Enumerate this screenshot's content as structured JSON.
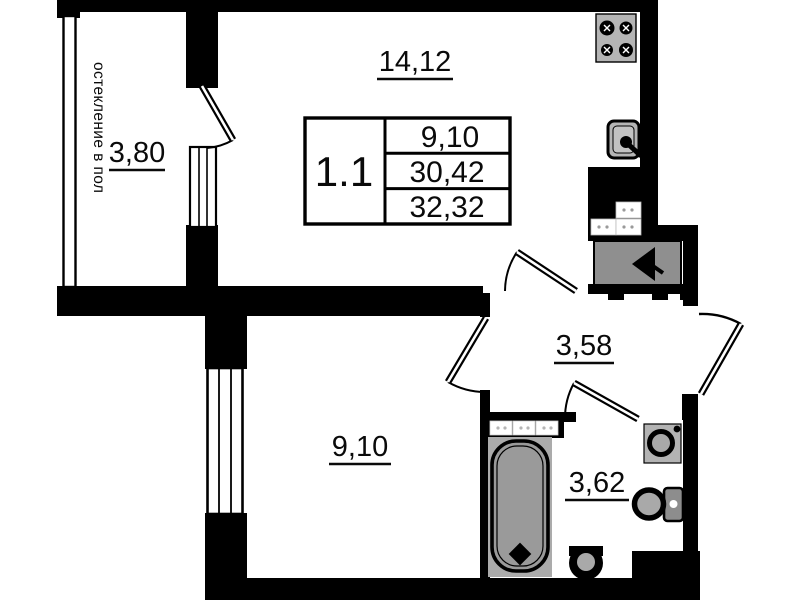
{
  "unit_card": {
    "unit_number": "1.1",
    "rows": [
      "9,10",
      "30,42",
      "32,32"
    ]
  },
  "labels": {
    "kitchen_living_area": "14,12",
    "balcony_area": "3,80",
    "balcony_note": "остекление в пол",
    "room_area": "9,10",
    "hall_area": "3,58",
    "bathroom_area": "3,62"
  },
  "icons": [
    "stove-icon",
    "kitchen-sink-icon",
    "vent-shaft-icon",
    "bathtub-icon",
    "washbasin-icon",
    "corner-sink-icon",
    "toilet-icon"
  ],
  "colors": {
    "wall": "#000000",
    "background": "#ffffff",
    "fixture": "#a9a9a9",
    "fixture_dark": "#8d8d8d"
  }
}
